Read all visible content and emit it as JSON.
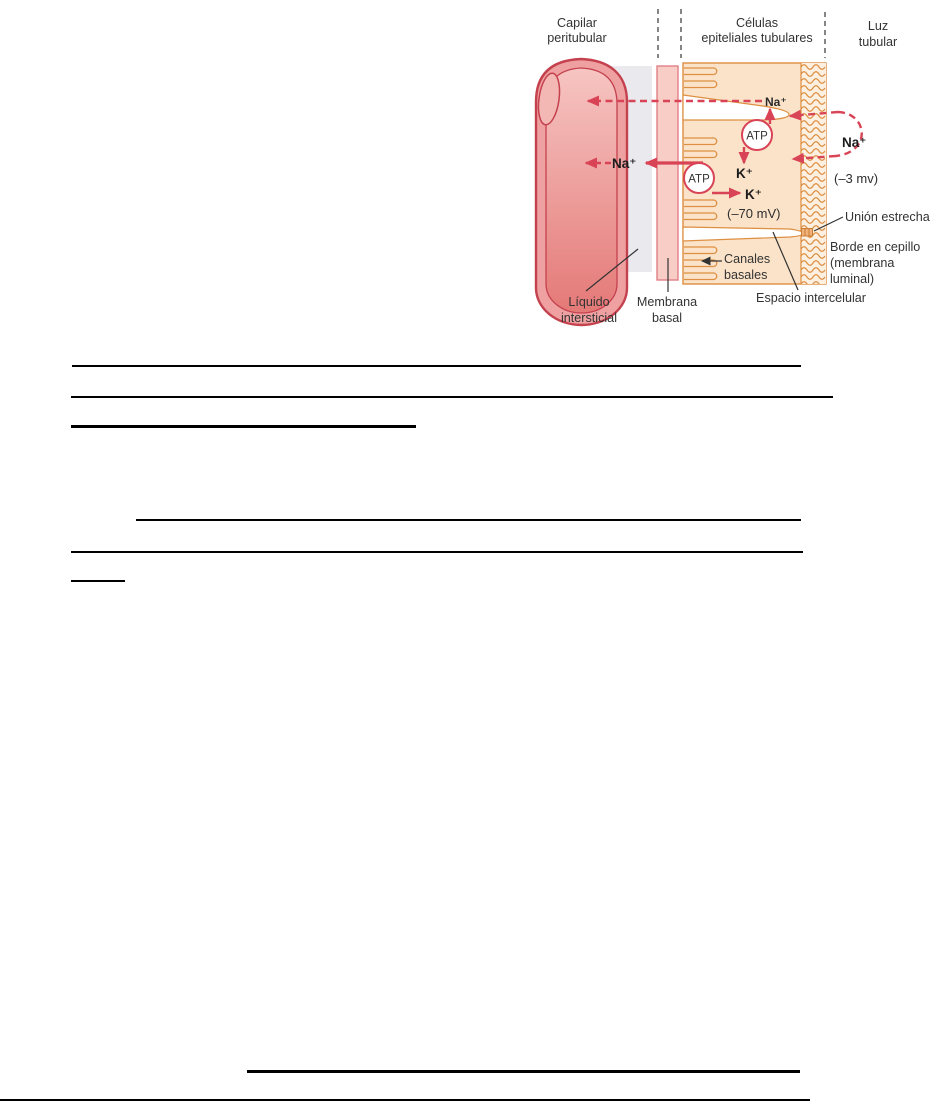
{
  "figure": {
    "headers": {
      "capillary_line1": "Capilar",
      "capillary_line2": "peritubular",
      "cells_line1": "Células",
      "cells_line2": "epiteliales tubulares",
      "lumen_line1": "Luz",
      "lumen_line2": "tubular"
    },
    "molecules": {
      "na_top": "Na⁺",
      "na_left": "Na⁺",
      "na_lumen": "Na⁺",
      "atp": "ATP",
      "k_upper": "K⁺",
      "k_lower": "K⁺",
      "potential_cell": "(–70 mV)",
      "potential_lumen": "(–3 mv)"
    },
    "callouts": {
      "tight_junction": "Unión estrecha",
      "brush_border_line1": "Borde en cepillo",
      "brush_border_line2": "(membrana",
      "brush_border_line3": "luminal)",
      "basal_channels_line1": "Canales",
      "basal_channels_line2": "basales",
      "interstitial_line1": "Líquido",
      "interstitial_line2": "intersticial",
      "basement_line1": "Membrana",
      "basement_line2": "basal",
      "intercellular_space": "Espacio intercelular"
    },
    "colors": {
      "arrow_red": "#d94356",
      "cell_outline": "#dd8f42",
      "cell_fill": "#fbe3c9",
      "capillary_outline": "#c4414e",
      "membrane_fill": "#f8cdc6",
      "interstitium_gray": "#e9e9ee",
      "label_text": "#333333"
    }
  }
}
